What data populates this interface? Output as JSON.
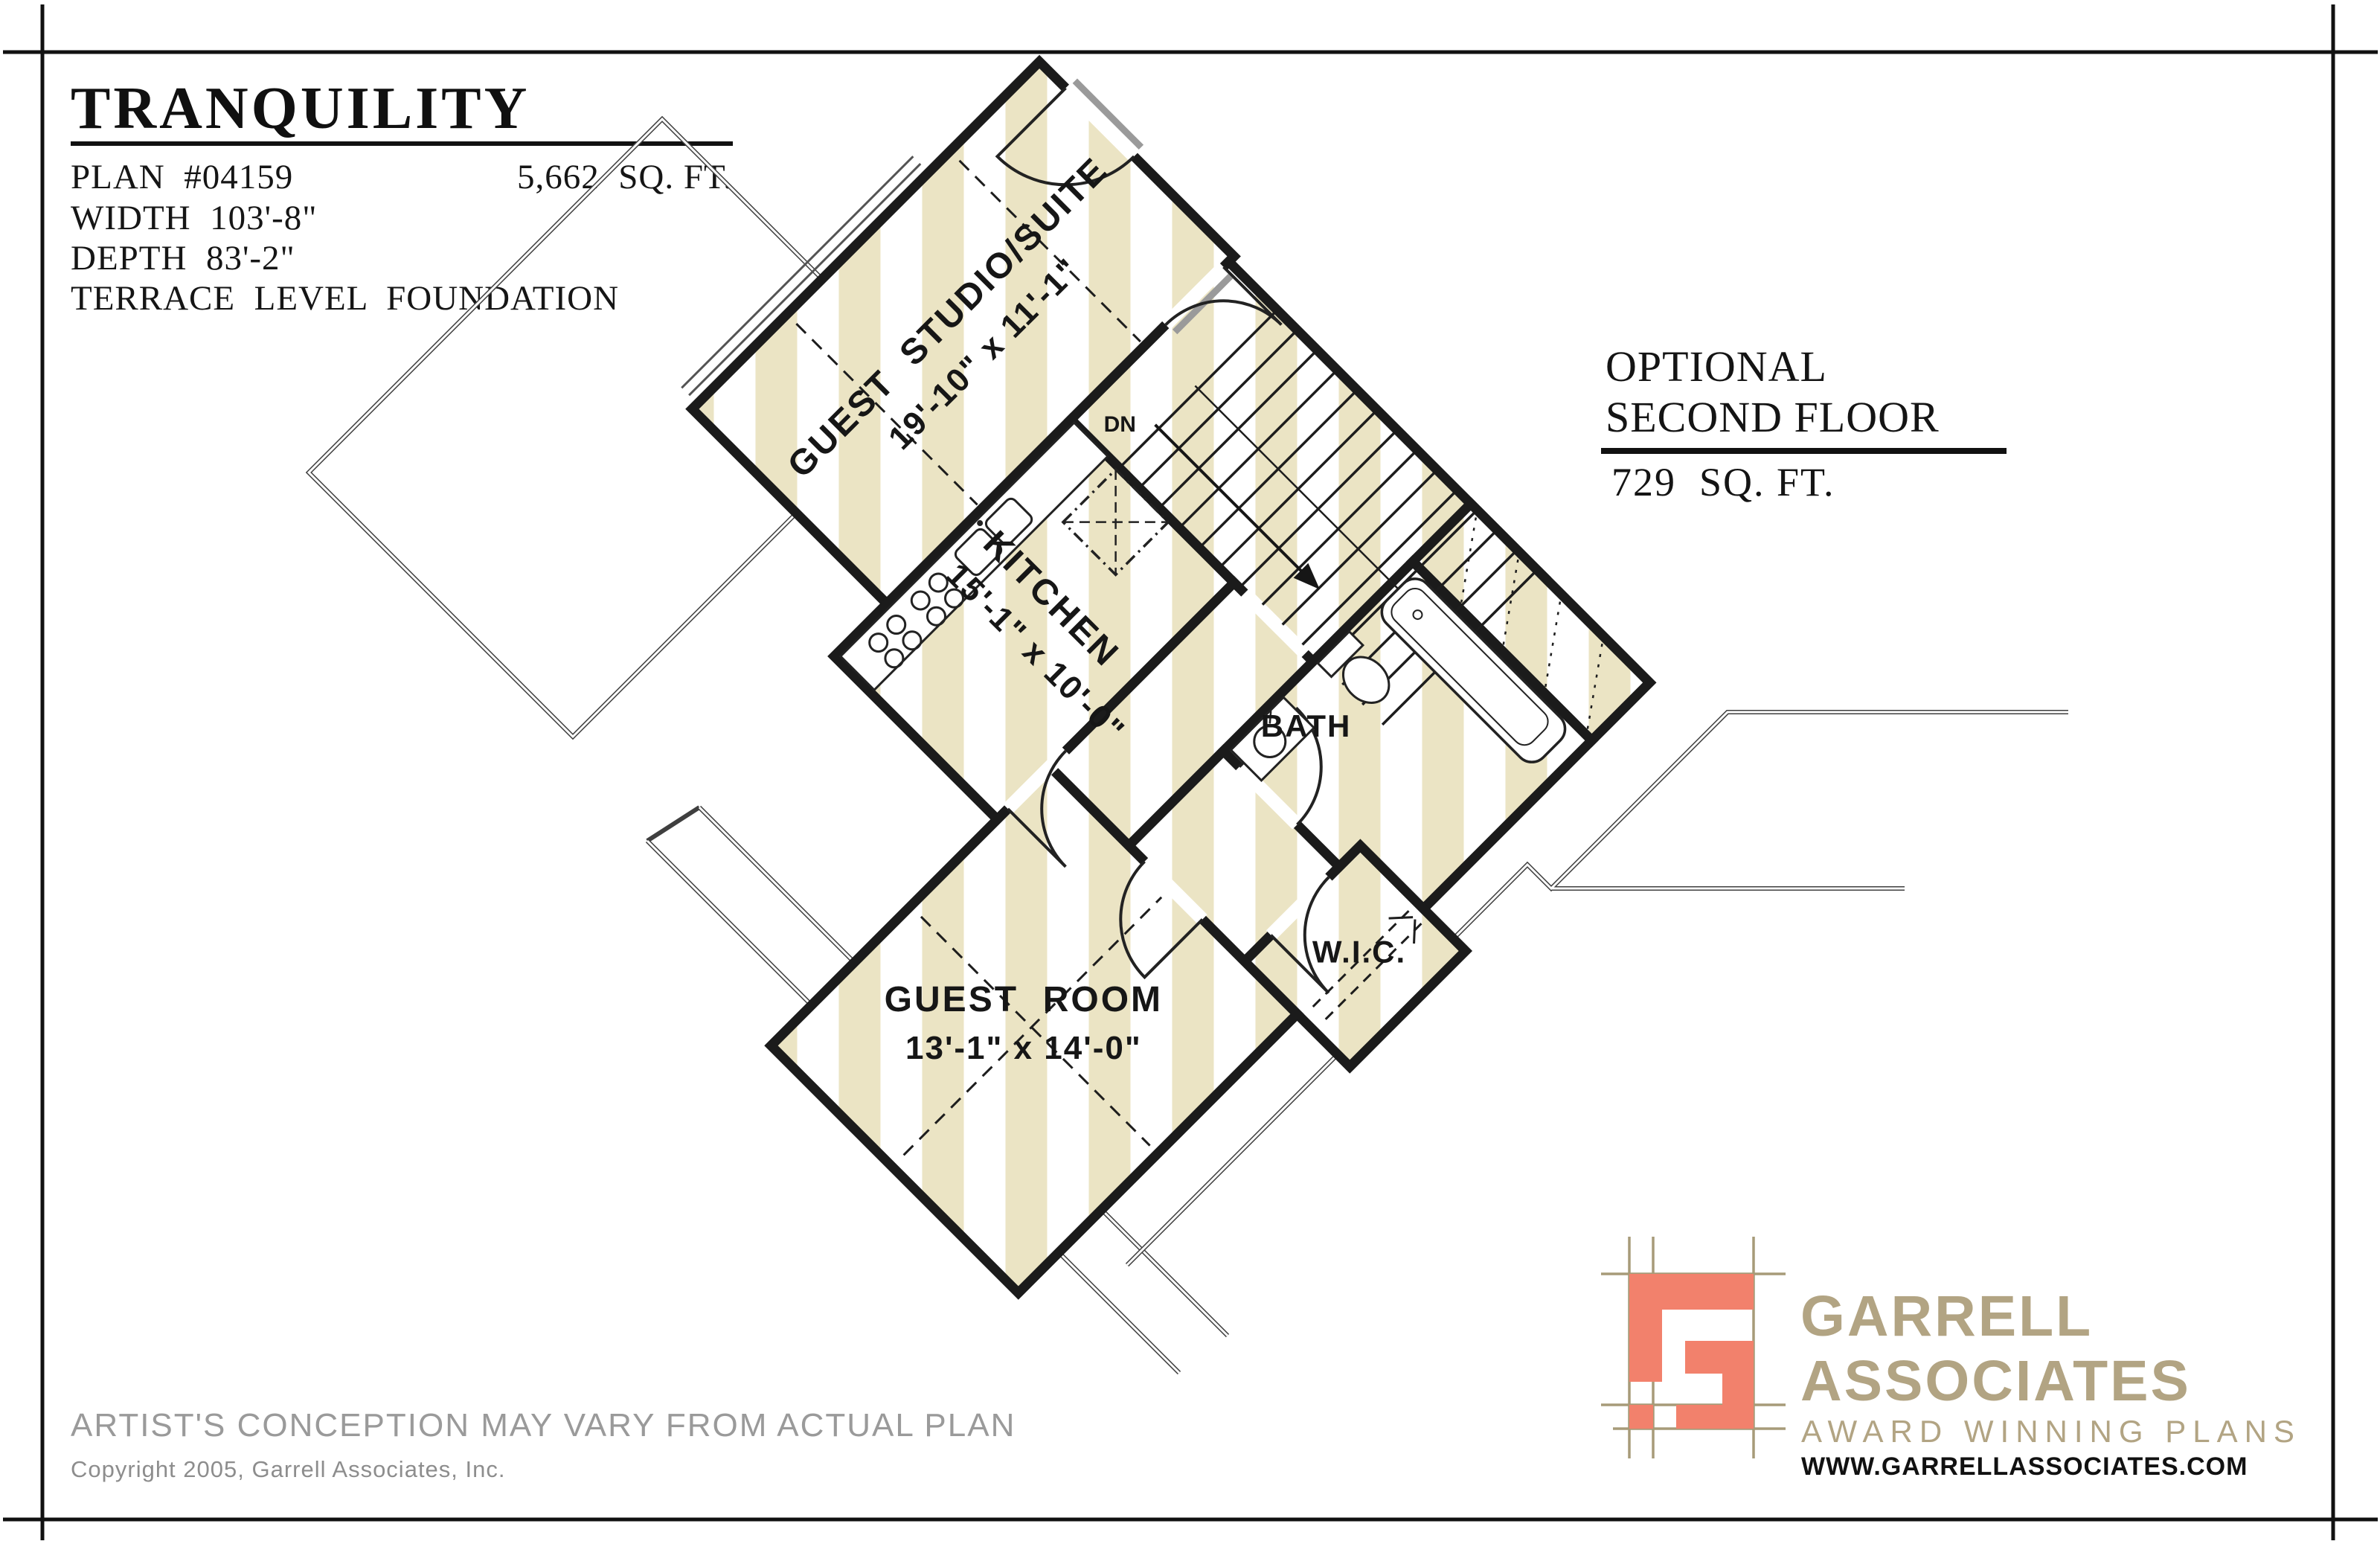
{
  "header": {
    "title": "TRANQUILITY",
    "plan_number": "PLAN  #04159",
    "total_sqft": "5,662  SQ. FT.",
    "width": "WIDTH  103'-8\"",
    "depth": "DEPTH  83'-2\"",
    "foundation": "TERRACE  LEVEL  FOUNDATION"
  },
  "floor_info": {
    "line1": "OPTIONAL",
    "line2": "SECOND FLOOR",
    "area": "729  SQ. FT."
  },
  "plan": {
    "guest_suite": {
      "name": "GUEST  STUDIO/SUITE",
      "dims": "19'-10\" x 11'-1\""
    },
    "kitchen": {
      "name": "KITCHEN",
      "dims": "15'-1\" x 10'-0\""
    },
    "bath": {
      "name": "BATH"
    },
    "wic": {
      "name": "W.I.C."
    },
    "guest_room": {
      "name": "GUEST  ROOM",
      "dims": "13'-1\" x 14'-0\""
    },
    "stairs": {
      "down_label": "DN"
    }
  },
  "footer": {
    "disclaimer": "ARTIST'S CONCEPTION MAY VARY FROM ACTUAL PLAN",
    "copyright": "Copyright 2005, Garrell Associates, Inc."
  },
  "logo": {
    "line1": "GARRELL",
    "line2": "ASSOCIATES",
    "tagline": "AWARD WINNING PLANS",
    "website": "WWW.GARRELLASSOCIATES.COM"
  },
  "colors": {
    "accent_salmon": "#F2816C",
    "brand_tan": "#B2A483",
    "stripe_beige": "#EBE4C4",
    "muted_gray": "#9A9A9A",
    "wall_black": "#1B1B1B"
  }
}
